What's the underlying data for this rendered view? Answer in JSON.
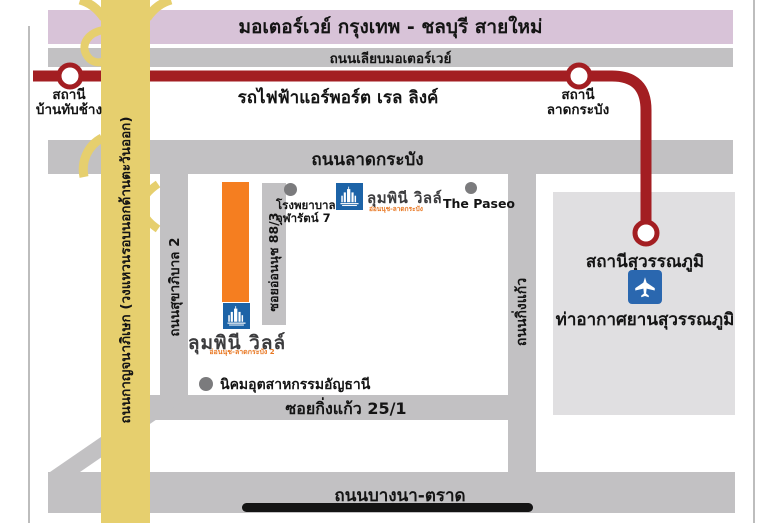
{
  "colors": {
    "motorway_pink": "#D8C3D8",
    "road_gray": "#C2C1C3",
    "airport_gray": "#E0DFE1",
    "rail_red": "#A31E22",
    "ring_yellow": "#E6CF6E",
    "site_orange": "#F57E20",
    "logo_blue": "#1C63A7",
    "sign_blue": "#2A67AF",
    "marker_gray": "#7B7B7D",
    "bar_black": "#141414",
    "thin_line_gray": "#BDBDBD",
    "subtitle_orange": "#E87722",
    "logo_text_gray": "#3C3C3E"
  },
  "motorway": {
    "label": "มอเตอร์เวย์ กรุงเทพ - ชลบุรี สายใหม่"
  },
  "frontage": {
    "label": "ถนนเลียบมอเตอร์เวย์"
  },
  "rail": {
    "label": "รถไฟฟ้าแอร์พอร์ต เรล ลิงค์",
    "station_ban_thap_chang": {
      "line1": "สถานี",
      "line2": "บ้านทับช้าง"
    },
    "station_lat_krabang": {
      "line1": "สถานี",
      "line2": "ลาดกระบัง"
    },
    "station_suvarnabhumi": {
      "label": "สถานีสุวรรณภูมิ"
    }
  },
  "roads": {
    "lat_krabang": {
      "label": "ถนนลาดกระบัง"
    },
    "kanchanaphisek": {
      "label": "ถนนกาญจนาภิเษก (วงแหวนรอบนอกด้านตะวันออก)"
    },
    "sukhaphiban_2": {
      "label": "ถนนสุขาภิบาล 2"
    },
    "soi_on_nut_88_3": {
      "label": "ซอยอ่อนนุช 88/3"
    },
    "king_kaeo": {
      "label": "ถนนกิ่งแก้ว"
    },
    "soi_king_kaeo_25_1": {
      "label": "ซอยกิ่งแก้ว 25/1"
    },
    "bang_na_trat": {
      "label": "ถนนบางนา-ตราด"
    }
  },
  "airport": {
    "label": "ท่าอากาศยานสุวรรณภูมิ"
  },
  "places": {
    "hospital": {
      "line1": "โรงพยาบาล",
      "line2": "จุฬารัตน์ 7"
    },
    "the_paseo": {
      "label": "The Paseo"
    },
    "gemopolis": {
      "label": "นิคมอุตสาหกรรมอัญธานี"
    }
  },
  "project": {
    "site": {
      "name": "ลุมพินี วิลล์",
      "subtitle": "อ่อนนุช-ลาดกระบัง 2"
    },
    "nearby": {
      "name": "ลุมพินี วิลล์",
      "subtitle": "อ่อนนุช-ลาดกระบัง"
    }
  }
}
